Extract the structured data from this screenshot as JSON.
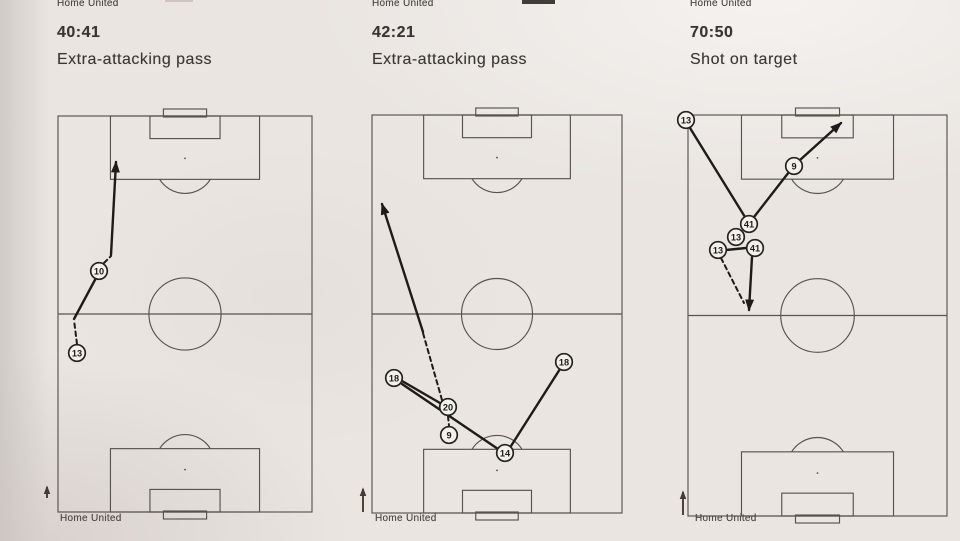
{
  "panels": [
    {
      "team_top": "Home United",
      "time": "40:41",
      "event": "Extra-attacking pass",
      "team_bottom": "Home United",
      "pitch": {
        "x": 58,
        "y": 116,
        "w": 254,
        "h": 396
      },
      "players": [
        {
          "num": "10",
          "x": 99,
          "y": 271
        },
        {
          "num": "13",
          "x": 77,
          "y": 353
        }
      ],
      "lines": [
        {
          "x1": 77,
          "y1": 344,
          "x2": 74,
          "y2": 320,
          "dashed": true,
          "arrow": false,
          "kind": "carry"
        },
        {
          "x1": 74,
          "y1": 319,
          "x2": 96,
          "y2": 278,
          "dashed": false,
          "arrow": false,
          "kind": "pass"
        },
        {
          "x1": 104,
          "y1": 263,
          "x2": 111,
          "y2": 256,
          "dashed": true,
          "arrow": false,
          "kind": "carry"
        },
        {
          "x1": 111,
          "y1": 255,
          "x2": 116,
          "y2": 162,
          "dashed": false,
          "arrow": true,
          "kind": "pass"
        }
      ],
      "direction_arrow": {
        "x": 47,
        "y1": 498,
        "y2": 487
      }
    },
    {
      "team_top": "Home United",
      "time": "42:21",
      "event": "Extra-attacking pass",
      "team_bottom": "Home United",
      "pitch": {
        "x": 372,
        "y": 115,
        "w": 250,
        "h": 398
      },
      "players": [
        {
          "num": "18",
          "x": 394,
          "y": 378
        },
        {
          "num": "20",
          "x": 448,
          "y": 407
        },
        {
          "num": "9",
          "x": 449,
          "y": 435
        },
        {
          "num": "14",
          "x": 505,
          "y": 453
        },
        {
          "num": "18",
          "x": 564,
          "y": 362
        }
      ],
      "lines": [
        {
          "x1": 402,
          "y1": 381,
          "x2": 440,
          "y2": 403,
          "dashed": false,
          "arrow": false,
          "kind": "pass"
        },
        {
          "x1": 402,
          "y1": 384,
          "x2": 498,
          "y2": 449,
          "dashed": false,
          "arrow": false,
          "kind": "pass"
        },
        {
          "x1": 511,
          "y1": 446,
          "x2": 560,
          "y2": 369,
          "dashed": false,
          "arrow": false,
          "kind": "pass"
        },
        {
          "x1": 448,
          "y1": 416,
          "x2": 449,
          "y2": 426,
          "dashed": true,
          "arrow": false,
          "kind": "carry"
        },
        {
          "x1": 442,
          "y1": 400,
          "x2": 423,
          "y2": 333,
          "dashed": true,
          "arrow": false,
          "kind": "carry"
        },
        {
          "x1": 423,
          "y1": 332,
          "x2": 382,
          "y2": 204,
          "dashed": false,
          "arrow": true,
          "kind": "pass"
        }
      ],
      "direction_arrow": {
        "x": 363,
        "y1": 512,
        "y2": 489
      }
    },
    {
      "team_top": "Home United",
      "time": "70:50",
      "event": "Shot on target",
      "team_bottom": "Home United",
      "pitch": {
        "x": 688,
        "y": 115,
        "w": 259,
        "h": 401
      },
      "players": [
        {
          "num": "13",
          "x": 686,
          "y": 120
        },
        {
          "num": "41",
          "x": 749,
          "y": 224
        },
        {
          "num": "13",
          "x": 736,
          "y": 237
        },
        {
          "num": "41",
          "x": 755,
          "y": 248
        },
        {
          "num": "13",
          "x": 718,
          "y": 250
        },
        {
          "num": "9",
          "x": 794,
          "y": 166
        }
      ],
      "lines": [
        {
          "x1": 690,
          "y1": 128,
          "x2": 745,
          "y2": 217,
          "dashed": false,
          "arrow": false,
          "kind": "pass"
        },
        {
          "x1": 754,
          "y1": 217,
          "x2": 789,
          "y2": 172,
          "dashed": false,
          "arrow": false,
          "kind": "pass"
        },
        {
          "x1": 800,
          "y1": 160,
          "x2": 841,
          "y2": 123,
          "dashed": false,
          "arrow": true,
          "kind": "shot"
        },
        {
          "x1": 726,
          "y1": 250,
          "x2": 746,
          "y2": 248,
          "dashed": false,
          "arrow": false,
          "kind": "pass"
        },
        {
          "x1": 752,
          "y1": 257,
          "x2": 749,
          "y2": 310,
          "dashed": false,
          "arrow": true,
          "kind": "pass"
        },
        {
          "x1": 721,
          "y1": 258,
          "x2": 744,
          "y2": 303,
          "dashed": true,
          "arrow": false,
          "kind": "carry"
        }
      ],
      "direction_arrow": {
        "x": 683,
        "y1": 515,
        "y2": 492
      }
    }
  ],
  "artifacts": [
    {
      "x": 165,
      "y": 0,
      "w": 28,
      "h": 2,
      "color": "#cfc3c3"
    },
    {
      "x": 522,
      "y": 0,
      "w": 33,
      "h": 4,
      "color": "#403c3a"
    }
  ],
  "colors": {
    "pitch_line": "#57534f",
    "pass_line": "#1e1b19",
    "player_fill": "#f4f1ed",
    "player_stroke": "#262321",
    "direction_arrow": "#453a31",
    "paper": "#eae5e1"
  }
}
